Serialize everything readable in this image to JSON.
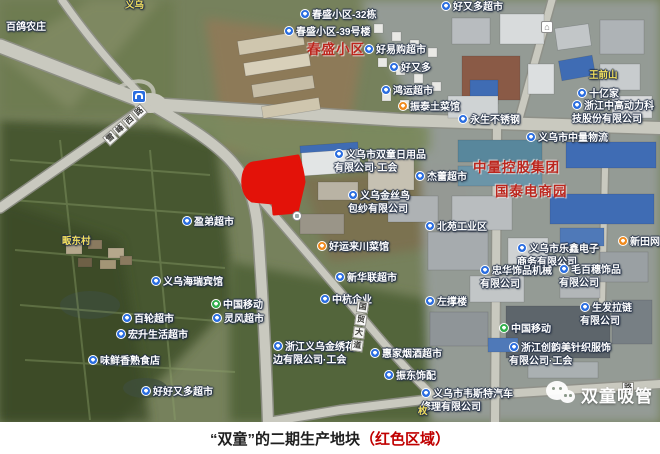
{
  "colors": {
    "highlight_red": "#e31209",
    "poi_blue": "#2a6de0",
    "poi_green": "#2fae4a",
    "poi_orange": "#f08a1d",
    "red_label": "#bc261d",
    "village_yellow": "#f2df5e",
    "caption_red": "#c00000",
    "caption_black": "#1f1f1f"
  },
  "caption": {
    "main": "“双童”的二期生产地块",
    "highlight": "（红色区域）"
  },
  "watermark": {
    "icon": "wechat-icon",
    "text": "双童吸管"
  },
  "map": {
    "labels": [
      {
        "text": "百鸽农庄",
        "x": 6,
        "y": 22,
        "style": "plain"
      },
      {
        "text": "义乌",
        "x": 125,
        "y": 0,
        "style": "village"
      },
      {
        "icon": "blue",
        "text": "春盛小区-32栋",
        "x": 300,
        "y": 9
      },
      {
        "icon": "blue",
        "text": "春盛小区-39号楼",
        "x": 284,
        "y": 26
      },
      {
        "text": "春盛小区",
        "x": 307,
        "y": 42,
        "style": "red-area"
      },
      {
        "icon": "blue",
        "text": "好易购超市",
        "x": 364,
        "y": 44
      },
      {
        "icon": "blue",
        "text": "好又多超市",
        "x": 441,
        "y": 1
      },
      {
        "icon": "blue",
        "text": "好又多",
        "x": 389,
        "y": 62
      },
      {
        "icon": "blue",
        "text": "鸿运超市",
        "x": 381,
        "y": 85
      },
      {
        "icon": "orange",
        "text": "振泰土菜馆",
        "x": 398,
        "y": 101
      },
      {
        "text": "王前山",
        "x": 589,
        "y": 70,
        "style": "village"
      },
      {
        "icon": "blue",
        "text": "十亿家",
        "x": 577,
        "y": 88
      },
      {
        "icon": "blue",
        "text": "浙江中高动力科\n技股份有限公司",
        "x": 572,
        "y": 100
      },
      {
        "icon": "blue",
        "text": "永生不锈钢",
        "x": 458,
        "y": 114
      },
      {
        "icon": "blue",
        "text": "义乌市中量物流",
        "x": 526,
        "y": 132
      },
      {
        "icon": "blue",
        "text": "义乌市双童日用品\n有限公司·工会",
        "x": 334,
        "y": 149
      },
      {
        "icon": "blue",
        "text": "杰蕾超市",
        "x": 415,
        "y": 171
      },
      {
        "text": "中量控股集团",
        "x": 473,
        "y": 160,
        "style": "red-area"
      },
      {
        "text": "国泰电商园",
        "x": 495,
        "y": 184,
        "style": "red-area"
      },
      {
        "icon": "blue",
        "text": "义乌金丝鸟\n包纱有限公司",
        "x": 348,
        "y": 190
      },
      {
        "icon": "blue",
        "text": "北苑工业区",
        "x": 425,
        "y": 221
      },
      {
        "icon": "orange",
        "text": "新田网咖",
        "x": 618,
        "y": 236
      },
      {
        "icon": "blue",
        "text": "义乌市乐鑫电子\n商务有限公司",
        "x": 517,
        "y": 243
      },
      {
        "icon": "blue",
        "text": "忠华饰品机械\n有限公司",
        "x": 480,
        "y": 265
      },
      {
        "icon": "blue",
        "text": "毛百穗饰品\n有限公司",
        "x": 559,
        "y": 264
      },
      {
        "icon": "blue",
        "text": "盈弟超市",
        "x": 182,
        "y": 216
      },
      {
        "icon": "orange",
        "text": "好运来川菜馆",
        "x": 317,
        "y": 241
      },
      {
        "icon": "blue",
        "text": "义乌海瑞宾馆",
        "x": 151,
        "y": 276
      },
      {
        "icon": "blue",
        "text": "新华联超市",
        "x": 335,
        "y": 272
      },
      {
        "icon": "blue",
        "text": "中杭企业",
        "x": 320,
        "y": 294
      },
      {
        "icon": "green",
        "text": "中国移动",
        "x": 211,
        "y": 299
      },
      {
        "icon": "blue",
        "text": "灵风超市",
        "x": 212,
        "y": 313
      },
      {
        "icon": "blue",
        "text": "百轮超市",
        "x": 122,
        "y": 313
      },
      {
        "icon": "blue",
        "text": "宏升生活超市",
        "x": 116,
        "y": 329
      },
      {
        "icon": "blue",
        "text": "味鲜香熟食店",
        "x": 88,
        "y": 355
      },
      {
        "icon": "blue",
        "text": "好好又多超市",
        "x": 141,
        "y": 386
      },
      {
        "icon": "blue",
        "text": "浙江义乌金绣花\n边有限公司·工会",
        "x": 273,
        "y": 341
      },
      {
        "icon": "blue",
        "text": "左撑楼",
        "x": 425,
        "y": 296
      },
      {
        "icon": "blue",
        "text": "惠家烟酒超市",
        "x": 370,
        "y": 348
      },
      {
        "icon": "blue",
        "text": "振东饰配",
        "x": 384,
        "y": 370
      },
      {
        "icon": "blue",
        "text": "义乌市韦斯特汽车\n修理有限公司",
        "x": 421,
        "y": 388
      },
      {
        "text": "枚",
        "x": 418,
        "y": 406,
        "style": "village"
      },
      {
        "icon": "blue",
        "text": "生发拉链\n有限公司",
        "x": 580,
        "y": 302
      },
      {
        "icon": "green",
        "text": "中国移动",
        "x": 499,
        "y": 323
      },
      {
        "icon": "blue",
        "text": "浙江创韵美针织服饰\n有限公司·工会",
        "x": 509,
        "y": 342
      },
      {
        "text": "畈东村",
        "x": 62,
        "y": 236,
        "style": "village"
      }
    ],
    "road_labels": [
      {
        "text": "雪峰西路",
        "x": 106,
        "y": 136,
        "angle": -42
      },
      {
        "text": "国贸大道",
        "x": 354,
        "y": 300,
        "vertical": true,
        "angle": 8
      },
      {
        "text": "路",
        "x": 622,
        "y": 382,
        "angle": 0
      }
    ],
    "badges": [
      {
        "type": "road-sign",
        "name": "road-sign-icon",
        "x": 132,
        "y": 90
      },
      {
        "type": "landmark",
        "name": "landmark-icon",
        "x": 541,
        "y": 21,
        "glyph": "⌂"
      },
      {
        "type": "marker",
        "name": "map-marker-icon",
        "x": 292,
        "y": 211
      }
    ]
  }
}
